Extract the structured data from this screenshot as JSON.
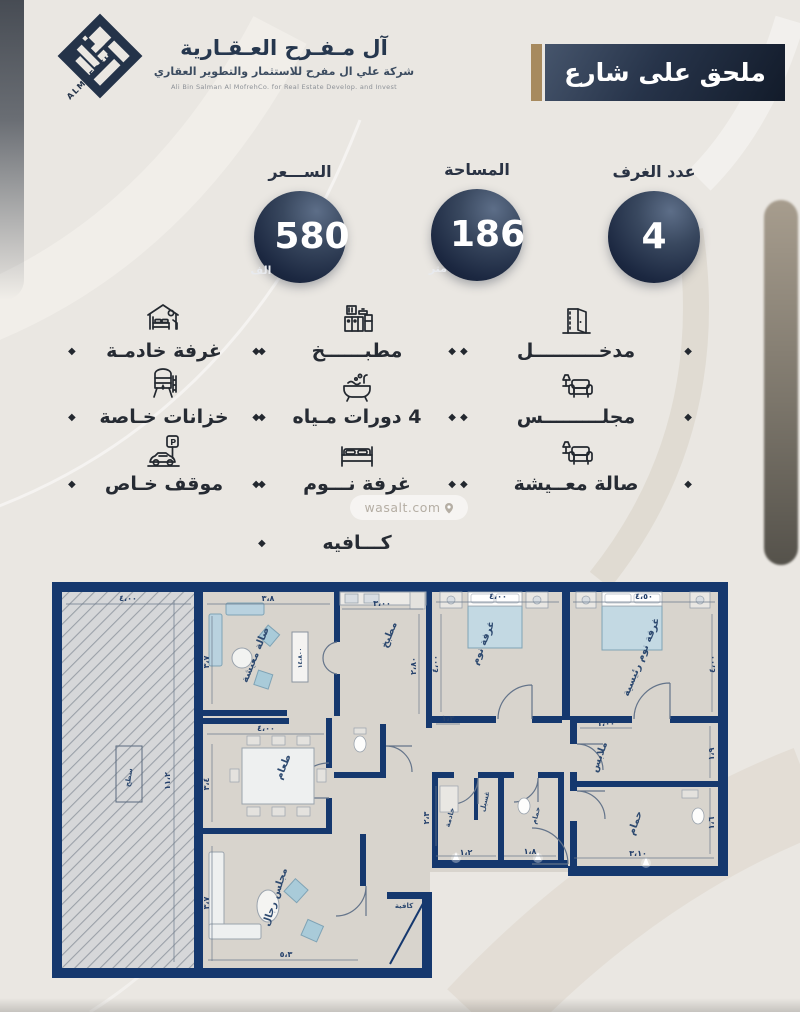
{
  "header": {
    "logo_mark": "ALMOFREH",
    "company_name": "آل مـفـرح العـقـارية",
    "company_subtitle": "شركة علي ال مفرح للاستثمار والتطوير العقاري",
    "company_subtitle_en": "Ali Bin Salman Al MofrehCo. for Real Estate Develop. and Invest",
    "banner_label": "ملحق على شارع"
  },
  "stats": [
    {
      "label": "عدد الغرف",
      "value": "4",
      "unit": ""
    },
    {
      "label": "المساحة",
      "value": "186",
      "unit": "متر"
    },
    {
      "label": "الســـعر",
      "value": "580",
      "unit": "الف"
    }
  ],
  "features": {
    "col_right": [
      {
        "icon": "door-icon",
        "label": "مدخــــــــــل"
      },
      {
        "icon": "majlis-sofa-icon",
        "label": "مجلـــــــــس"
      },
      {
        "icon": "living-sofa-icon",
        "label": "صالة معــيشة"
      }
    ],
    "col_middle": [
      {
        "icon": "kitchen-icon",
        "label": "مطبــــــخ"
      },
      {
        "icon": "bath-icon",
        "label": "4 دورات مـياه"
      },
      {
        "icon": "bed-icon",
        "label": "غرفة نـــوم"
      },
      {
        "icon": "",
        "label": "كـــافيه"
      }
    ],
    "col_left": [
      {
        "icon": "maid-room-icon",
        "label": "غرفة خادمـة"
      },
      {
        "icon": "tank-icon",
        "label": "خزانات خـاصة"
      },
      {
        "icon": "parking-icon",
        "label": "موقف خـاص"
      }
    ]
  },
  "icons": {
    "parking_letter": "P"
  },
  "watermark": "wasalt.com",
  "floorplan": {
    "labels": {
      "terrace": "سطح",
      "living": "صالة معيشة",
      "kitchen": "مطبخ",
      "bedroom": "غرفة نوم",
      "master": "غرفة نوم رئيسية",
      "dining": "طعام",
      "maid": "خادمة",
      "laundry": "غسيل",
      "bath1": "حمام",
      "bath2": "حمام",
      "closet": "ملابس",
      "majlis": "مجلس رجال",
      "cafe": "كافية",
      "tv_unit": "١٤،٨٠٠"
    },
    "dims": {
      "terrace_w": "٤،٠٠",
      "terrace_h": "١١،٢",
      "living_w": "٣،٨",
      "living_h": "٣،٧",
      "kitchen_w": "٣،٠٠",
      "kitchen_h": "٢،٨٠",
      "bedroom_w": "٤،٠٠",
      "bedroom_h": "٤،٠٠",
      "master_w": "٤،٥٠",
      "master_h": "٤،٠٠",
      "hall": "١،٣",
      "dining_w": "٤،٠٠",
      "dining_h": "٣،٤",
      "maid_w": "١،٢",
      "maid_h": "٢،٣",
      "bath1_w": "١،٨",
      "bath2_w": "٣،١٠",
      "bath2_h": "١،٦",
      "closet_w": "١،٠٠",
      "closet_h": "١،٩",
      "majlis_w": "٥،٣",
      "majlis_h": "٣،٧"
    }
  }
}
